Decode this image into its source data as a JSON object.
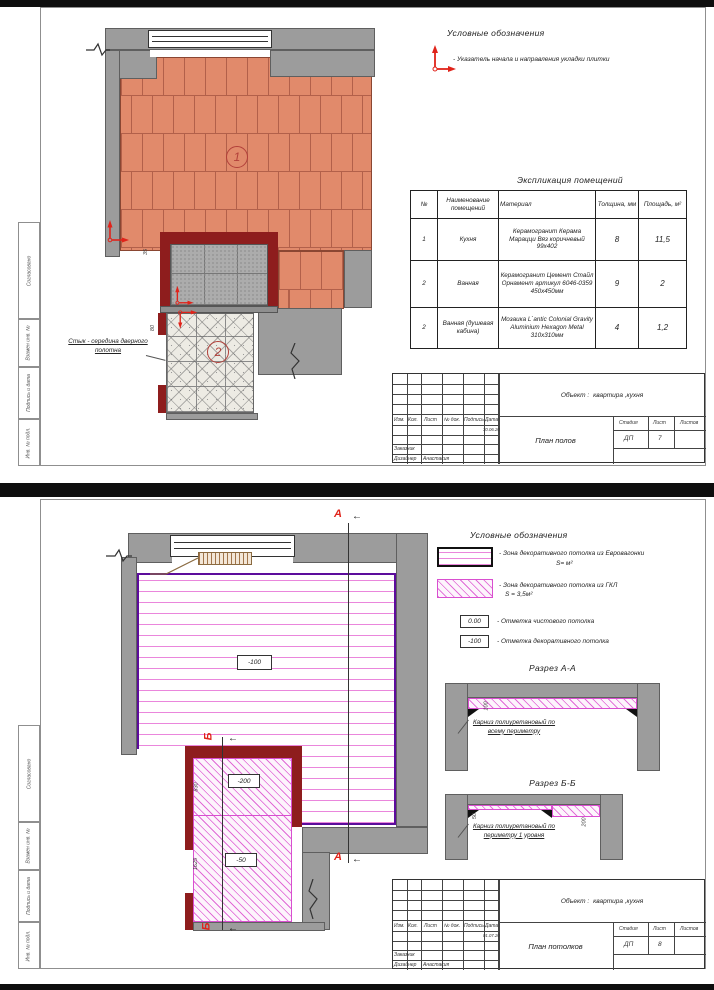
{
  "side_stamp": [
    "Согласовано",
    "Взамен инв. №",
    "Подпись и дата",
    "Инв. № подл."
  ],
  "tb_labels": {
    "izm": "Изм.",
    "kol": "Кол.",
    "list": "Лист",
    "doc": "№ док.",
    "sign": "Подпись",
    "date": "Дата",
    "stage": "Стадия",
    "sheet": "Лист",
    "sheets": "Листов",
    "customer": "Заказчик",
    "designer": "Дизайнер",
    "object_label": "Объект :"
  },
  "colors": {
    "accent_red": "#e0231a",
    "maroon_wall": "#8e1d1d",
    "wall_gray": "#9c9c9c",
    "tile_orange": "#e18a6b",
    "magenta": "#e06ad6",
    "zone_purple": "#5c0d9c",
    "cornice_brown": "#a0744a"
  },
  "sheet1": {
    "legend": {
      "title": "Условные обозначения",
      "item": "- Указатель начала и направления укладки плитки"
    },
    "expl": {
      "title": "Экспликация помещений",
      "headers": {
        "num": "№",
        "name": "Наименование помещений",
        "material": "Материал",
        "thickness": "Толщина, мм",
        "area": "Площадь, м²"
      },
      "rows": [
        {
          "num": "1",
          "name": "Кухня",
          "material": "Керамогранит Керама Марацци Вяз коричневый 99х402",
          "thickness": "8",
          "area": "11,5"
        },
        {
          "num": "2",
          "name": "Ванная",
          "material": "Керамогранит Цемент Стайл Орнамент артикул 6046-0359 450х450мм",
          "thickness": "9",
          "area": "2"
        },
        {
          "num": "2",
          "name": "Ванная (душевая кабина)",
          "material": "Мозаика L`antic Colonial Gravity Aluminium Hexagon Metal 310х310мм",
          "thickness": "4",
          "area": "1,2"
        }
      ]
    },
    "plan": {
      "room1": "1",
      "room2": "2",
      "dim35": "35",
      "dim80": "80",
      "note": "Стык - середина дверного полотна"
    },
    "tb": {
      "date": "30.06.20",
      "object": "квартира ,кухня",
      "stage": "ДП",
      "sheet_no": "7",
      "designer_name": "Анастасия",
      "drawing": "План полов"
    }
  },
  "sheet2": {
    "legend": {
      "title": "Условные обозначения",
      "item1": "- Зона декоративного потолка из Евровагонки",
      "item1s": "S= м²",
      "item2": "- Зона декоративного потолка из ГКЛ",
      "item2s": "S = 3,5м²",
      "mark0": "0.00",
      "mark0_text": "- Отметка чистового потолка",
      "mark100": "-100",
      "mark100_text": "- Отметка декоративного потолка"
    },
    "plan": {
      "level_main": "-100",
      "level200": "-200",
      "level50": "-50",
      "dim830": "830",
      "dim1625": "1625",
      "markA": "А",
      "markB": "Б",
      "arrow": "←"
    },
    "secAA": {
      "title": "Разрез А-А",
      "dim": "100",
      "note": "Карниз полиуретановый по всему периметру"
    },
    "secBB": {
      "title": "Разрез Б-Б",
      "dim50": "50",
      "dim200": "200",
      "note": "Карниз полиуретановый по периметру 1 уровня"
    },
    "tb": {
      "date": "01.07.20",
      "object": "квартира ,кухня",
      "stage": "ДП",
      "sheet_no": "8",
      "designer_name": "Анастасия",
      "drawing": "План потолков"
    }
  }
}
